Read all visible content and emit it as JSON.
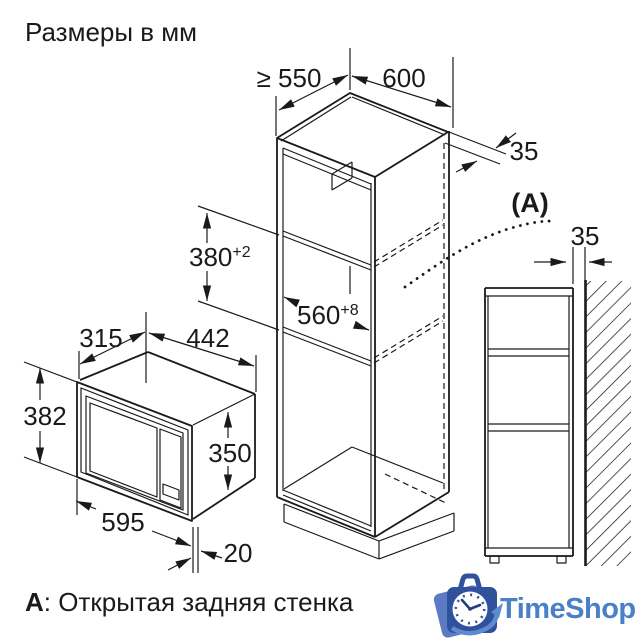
{
  "title": "Размеры в мм",
  "note": {
    "bold": "A",
    "rest": ": Открытая задняя стенка"
  },
  "labels": {
    "depth_min": "≥ 550",
    "cabinet_width": "600",
    "top_reveal": "35",
    "section_ref": "(A)",
    "wall_gap": "35",
    "niche_h": "380",
    "niche_h_sup": "+2",
    "niche_w": "560",
    "niche_w_sup": "+8",
    "mw_depth": "315",
    "mw_width": "442",
    "mw_front_h": "382",
    "mw_body_h": "350",
    "mw_front_w": "595",
    "mw_overhang": "20"
  },
  "logo": {
    "text": "TimeShop",
    "bag_color": "#30519c",
    "bag_back_color": "#5b7cc2",
    "swoosh_color": "#5e8ad0",
    "text_color": "#4a80c8",
    "clock_face_color": "#ffffff"
  },
  "colors": {
    "line": "#1a1a1a",
    "background": "#ffffff"
  }
}
